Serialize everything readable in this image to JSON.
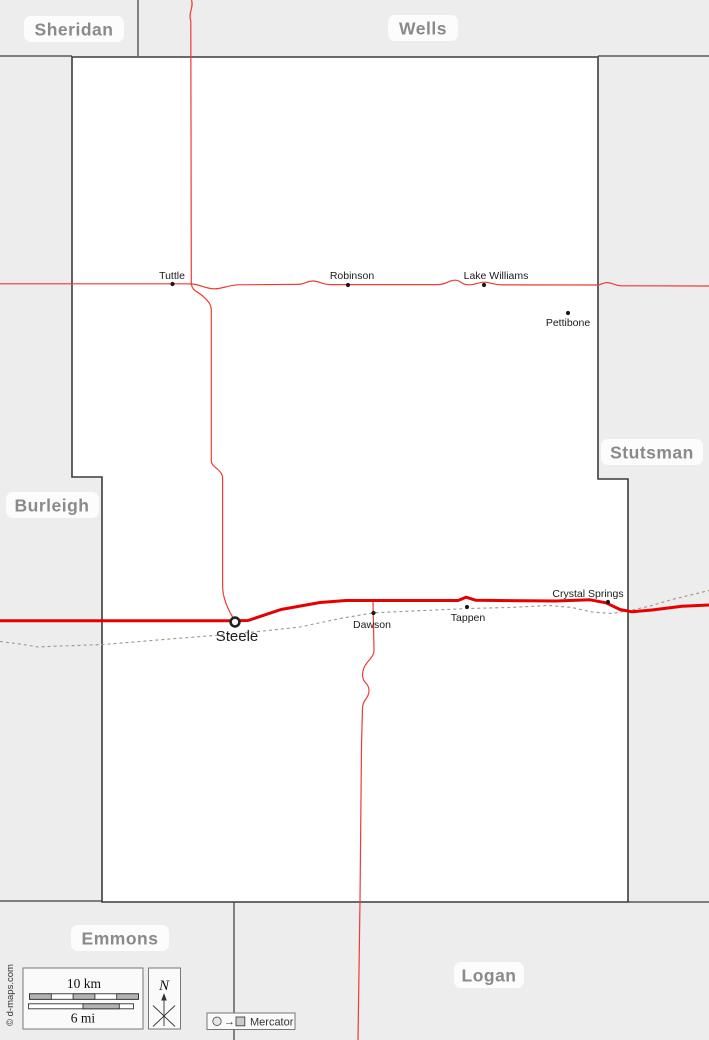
{
  "map": {
    "neighbors": [
      {
        "name": "Sheridan"
      },
      {
        "name": "Wells"
      },
      {
        "name": "Stutsman"
      },
      {
        "name": "Burleigh"
      },
      {
        "name": "Emmons"
      },
      {
        "name": "Logan"
      }
    ],
    "towns": [
      {
        "name": "Tuttle"
      },
      {
        "name": "Robinson"
      },
      {
        "name": "Lake Williams"
      },
      {
        "name": "Pettibone"
      },
      {
        "name": "Dawson"
      },
      {
        "name": "Tappen"
      },
      {
        "name": "Crystal Springs"
      }
    ],
    "county_seat": {
      "name": "Steele"
    },
    "legend": {
      "scale_km": "10 km",
      "scale_mi": "6 mi",
      "north": "N",
      "projection": "Mercator",
      "projection_arrow": "→",
      "credit": "© d-maps.com"
    },
    "colors": {
      "background": "#ededed",
      "county_fill": "#ffffff",
      "boundary": "#3c3c3c",
      "road_major": "#e60000",
      "road_minor": "#ee3b33",
      "railroad": "#a59384",
      "county_label": "#8a8a8a",
      "town_label": "#1a1a1a"
    }
  }
}
